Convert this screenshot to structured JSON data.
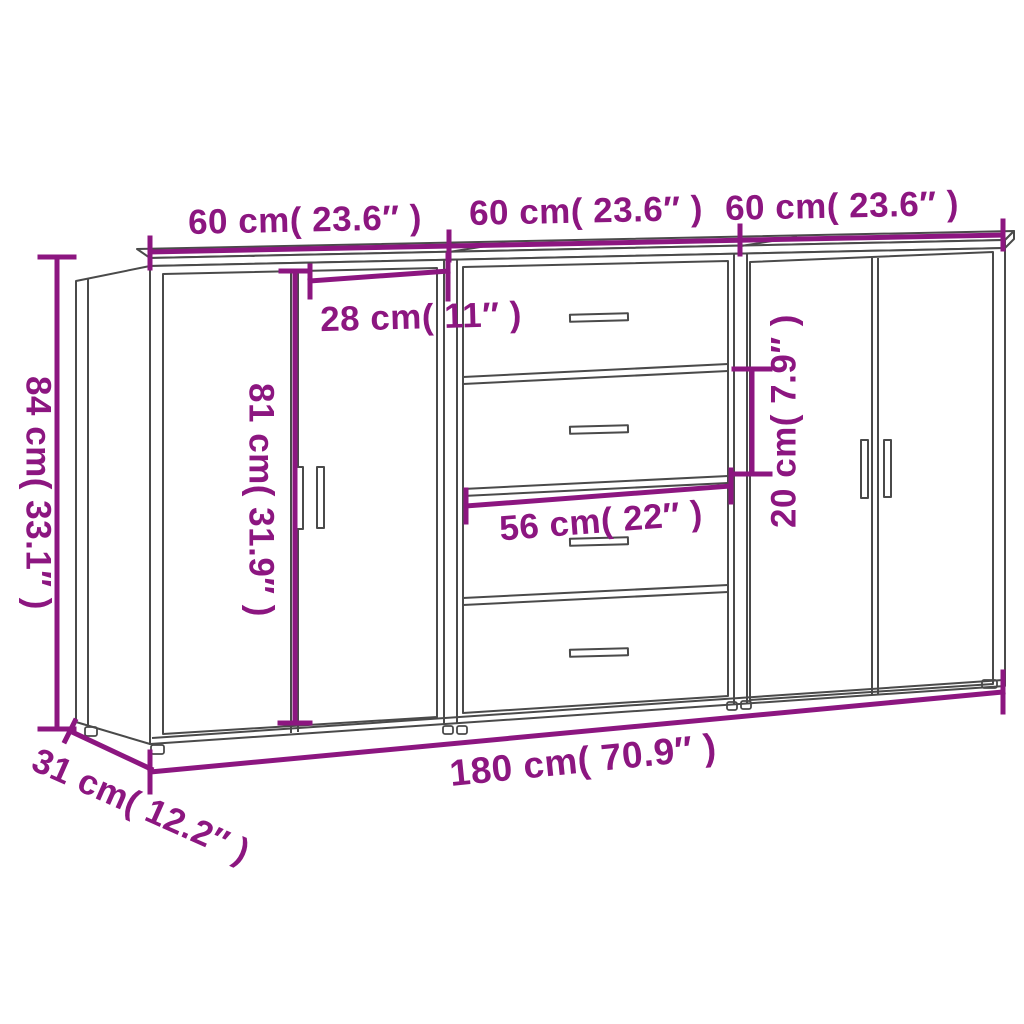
{
  "diagram": {
    "type": "furniture-dimension-diagram",
    "subject": "Set of 3 sideboards (doors / 4 drawers / doors)",
    "units": [
      "cm",
      "inches"
    ]
  },
  "colors": {
    "dimension_accent": "#8c1680",
    "line_art": "#4a4a4a",
    "background": "#ffffff"
  },
  "labels": {
    "unit1_width": "60 cm( 23.6″ )",
    "unit2_width": "60 cm( 23.6″ )",
    "unit3_width": "60 cm( 23.6″ )",
    "total_height": "84 cm( 33.1″ )",
    "door_width": "28 cm( 11″ )",
    "door_height": "81 cm( 31.9″ )",
    "drawer_width": "56 cm( 22″ )",
    "drawer_height": "20 cm( 7.9″ )",
    "total_width": "180 cm( 70.9″ )",
    "depth": "31 cm( 12.2″ )"
  }
}
